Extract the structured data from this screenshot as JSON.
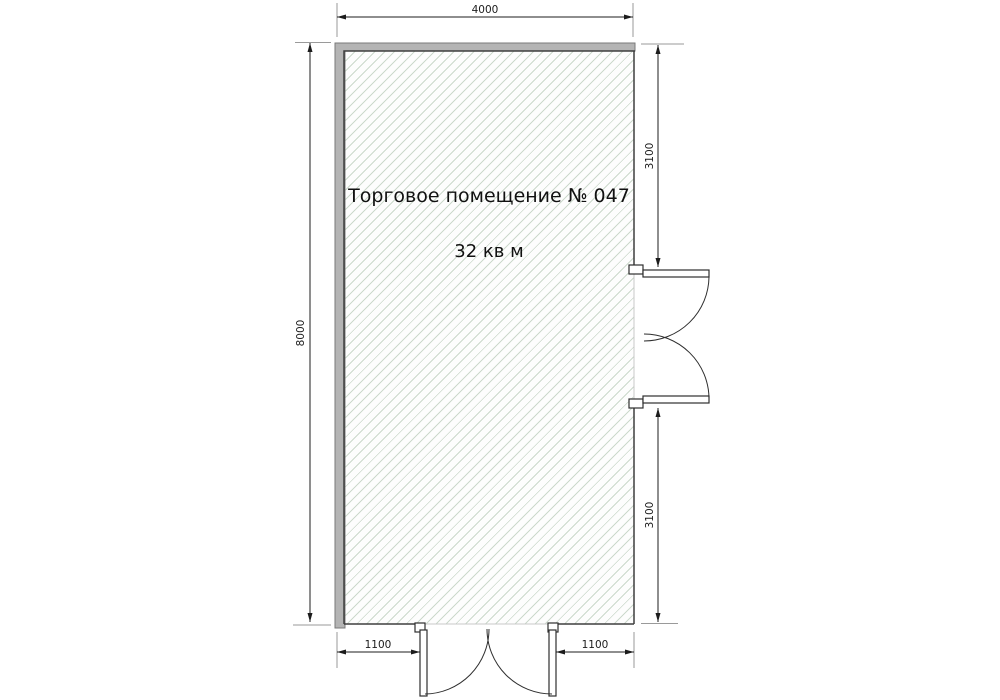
{
  "floor_plan": {
    "room": {
      "name": "Торговое помещение № 047",
      "area": "32 кв м"
    },
    "dimensions": {
      "top_width": "4000",
      "left_height": "8000",
      "right_upper": "3100",
      "right_lower": "3100",
      "bottom_left": "1100",
      "bottom_right": "1100"
    },
    "colors": {
      "wall_fill": "#b4b4b4",
      "wall_outline": "#7a7a7a",
      "inner_wall_edge": "#3f3f3f",
      "hatch_line": "#ccd9cc",
      "floor_fill": "#fdfdfd",
      "dimension_line": "#1c1c1c",
      "extension_line": "#9a9a9a",
      "door_line": "#2e2e2e",
      "text": "#111111"
    }
  }
}
